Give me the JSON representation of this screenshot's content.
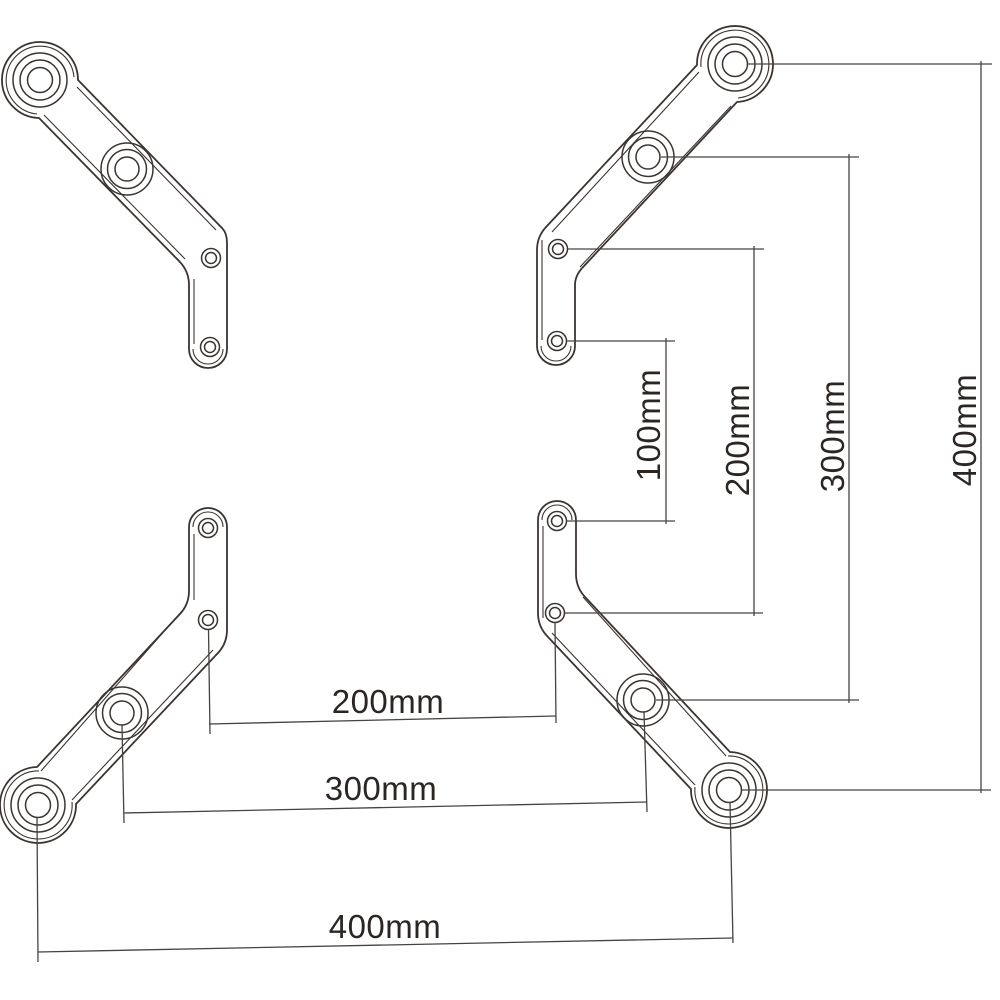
{
  "figure": {
    "background_color": "#ffffff",
    "line_color": "#3b3431",
    "text_color": "#2b2623"
  },
  "vertical_dimensions": [
    {
      "label": "100mm"
    },
    {
      "label": "200mm"
    },
    {
      "label": "300mm"
    },
    {
      "label": "400mm"
    }
  ],
  "horizontal_dimensions": [
    {
      "label": "200mm"
    },
    {
      "label": "300mm"
    },
    {
      "label": "400mm"
    }
  ]
}
